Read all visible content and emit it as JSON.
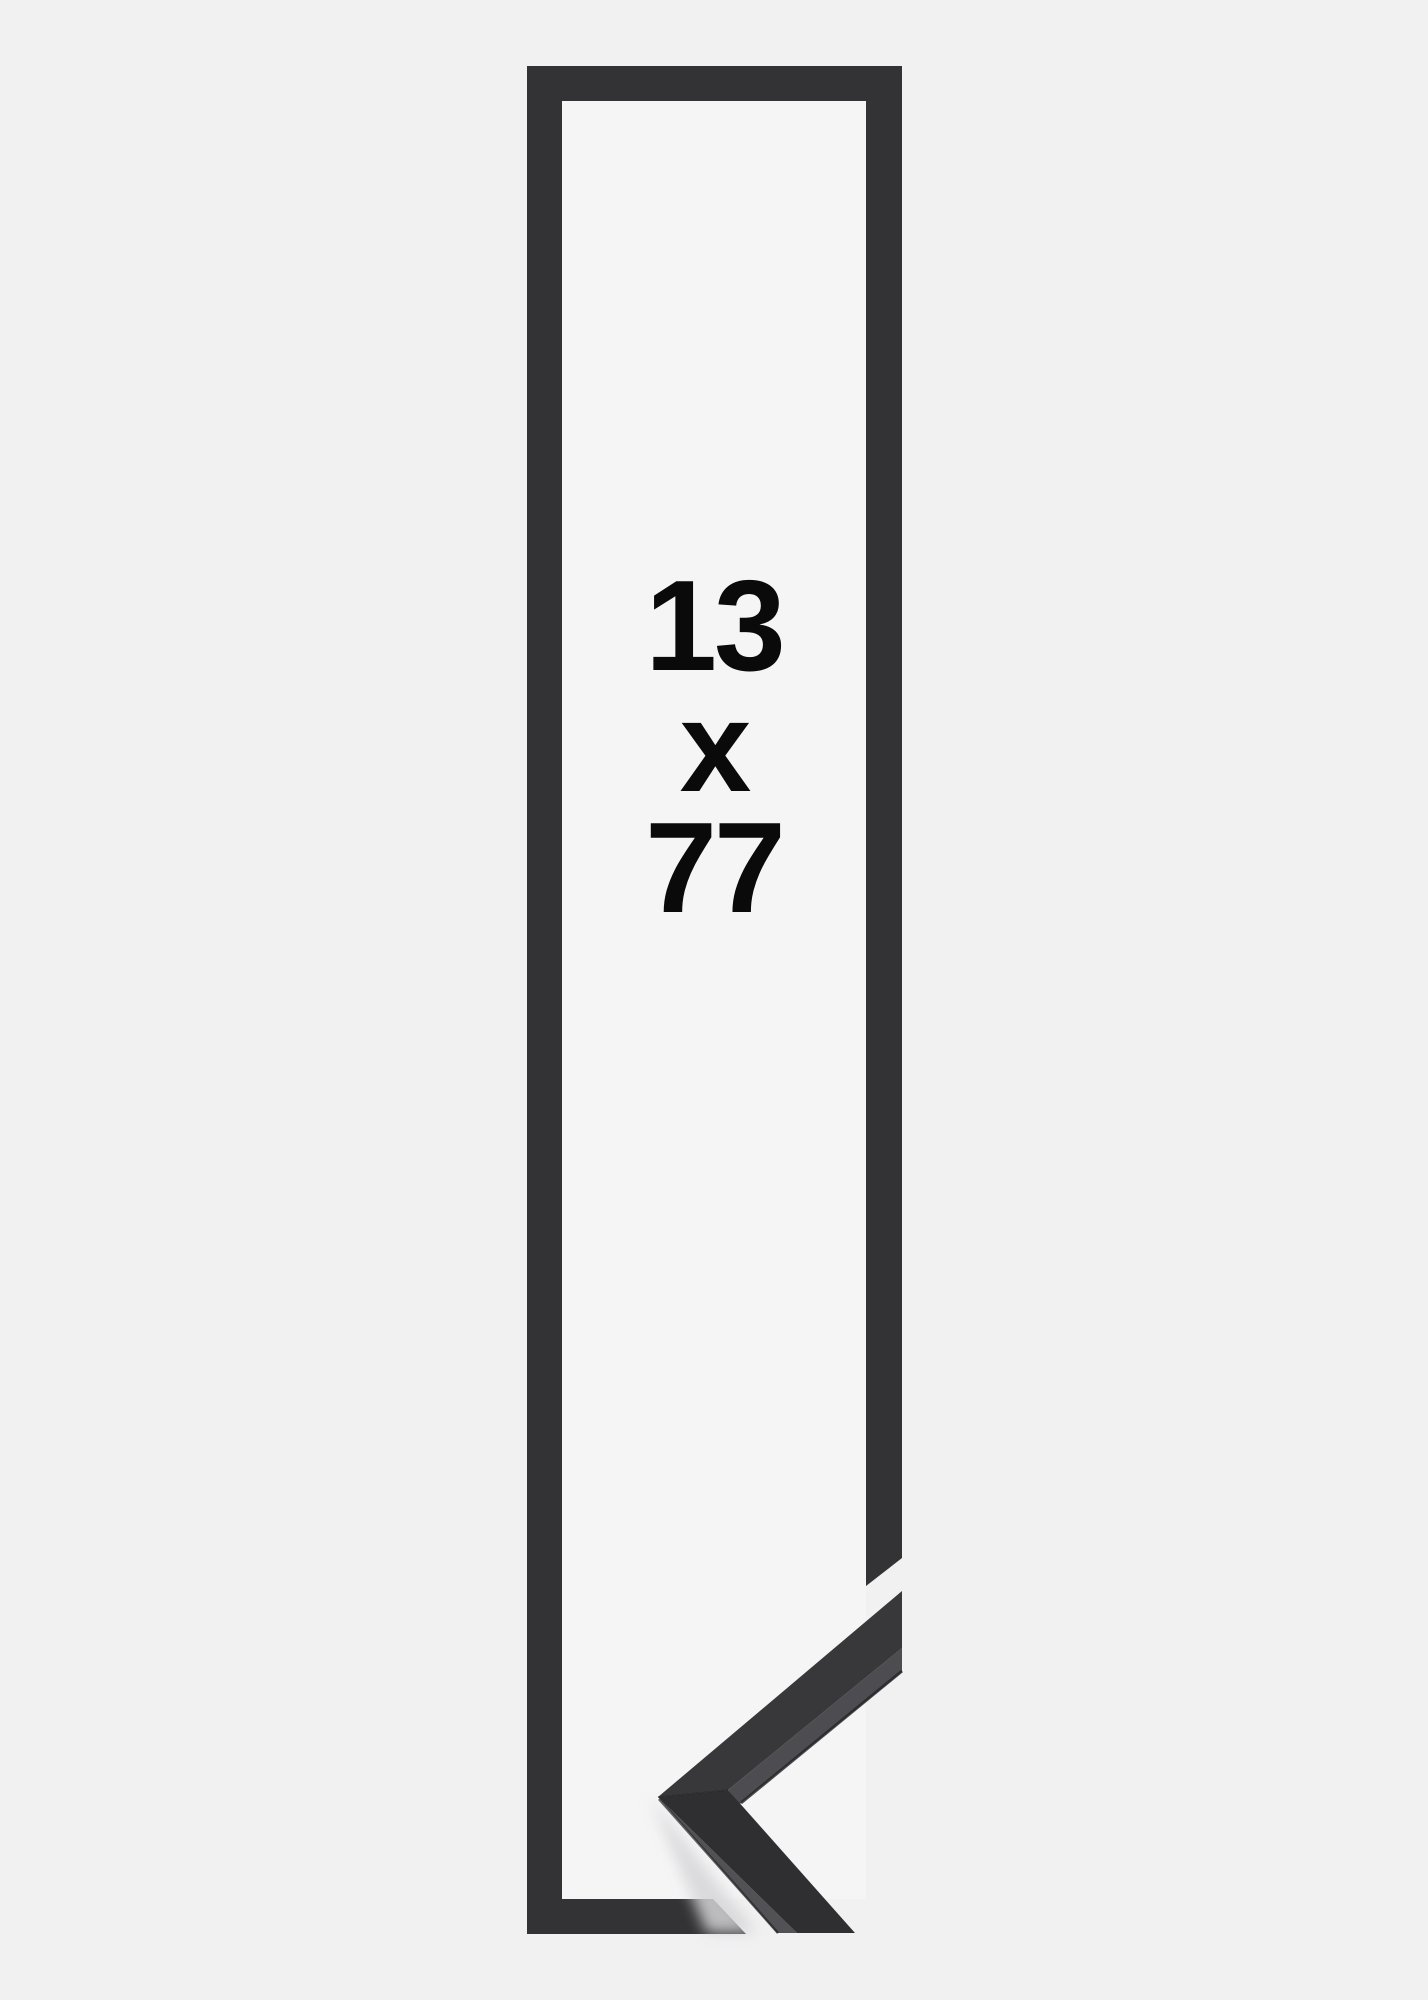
{
  "product_image": {
    "description": "frame-size-sample-preview",
    "size_label": {
      "width_value": "13",
      "separator": "x",
      "height_value": "77",
      "full": "13 x 77"
    },
    "colors": {
      "background": "#f1f1f2",
      "interior": "#f5f5f6",
      "frame_bar": "#333335",
      "moulding_face_upper": "#38383a",
      "moulding_face_lower": "#2f2f31",
      "moulding_side_upper": "#4d4d51",
      "moulding_side_lower": "#525256",
      "seam": "#232325",
      "shadow": "#d5d5d7",
      "text": "#0a0a0b"
    }
  }
}
